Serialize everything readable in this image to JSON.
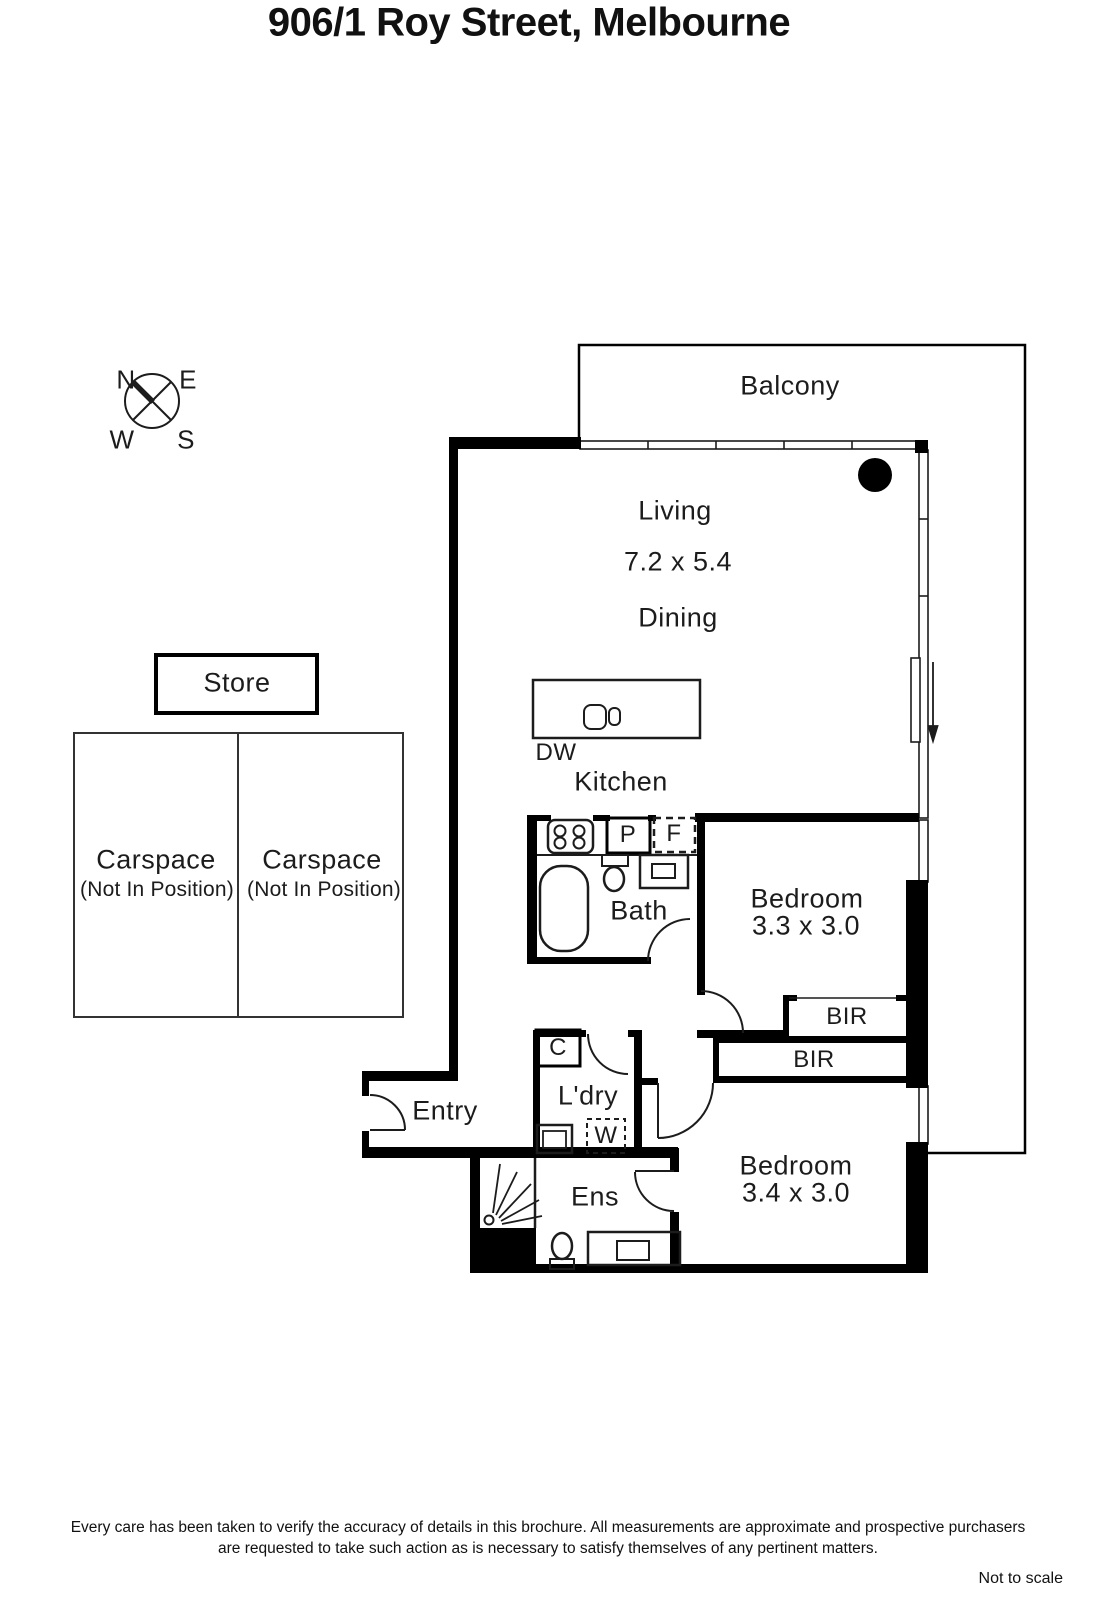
{
  "title": "906/1 Roy Street, Melbourne",
  "compass": {
    "north": "N",
    "east": "E",
    "west": "W",
    "south": "S"
  },
  "plan": {
    "balcony": "Balcony",
    "living": "Living",
    "living_dims": "7.2 x 5.4",
    "dining": "Dining",
    "kitchen": "Kitchen",
    "dishwasher": "DW",
    "store": "Store",
    "carspace_left": {
      "label": "Carspace",
      "note": "(Not In Position)"
    },
    "carspace_right": {
      "label": "Carspace",
      "note": "(Not In Position)"
    },
    "bath": "Bath",
    "pantry": "P",
    "fridge": "F",
    "bedroom1": {
      "label": "Bedroom",
      "dims": "3.3 x 3.0"
    },
    "bir_top": "BIR",
    "bir_bottom": "BIR",
    "entry": "Entry",
    "cupboard": "C",
    "laundry": "L'dry",
    "washer": "W",
    "ensuite": "Ens",
    "bedroom2": {
      "label": "Bedroom",
      "dims": "3.4 x 3.0"
    }
  },
  "footer": {
    "line1": "Every care has been taken to verify the accuracy of details in this brochure.  All measurements are approximate and prospective purchasers",
    "line2": "are requested to take such action as is necessary to satisfy themselves of any pertinent matters.",
    "scale_note": "Not to scale"
  },
  "colors": {
    "wall": "#000000",
    "line": "#1c1c1c",
    "background": "#ffffff"
  }
}
